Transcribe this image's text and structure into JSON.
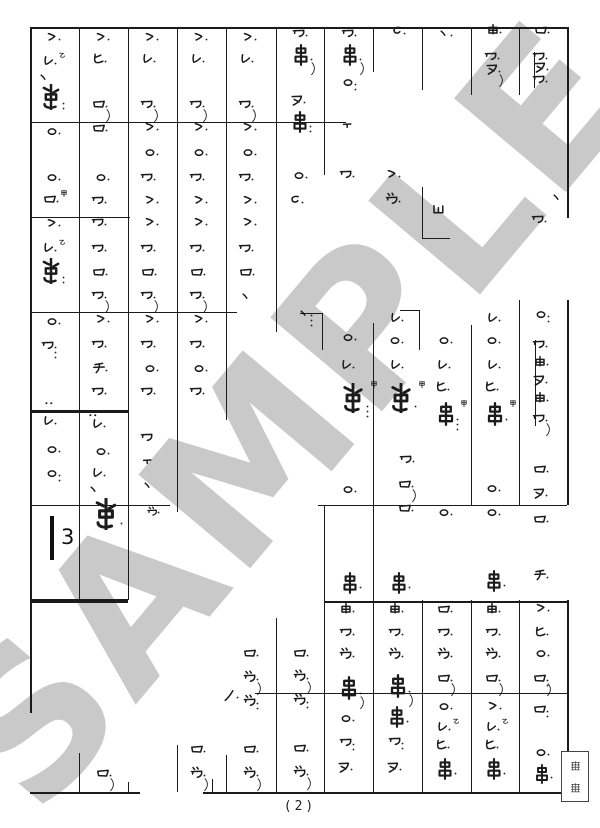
{
  "page": {
    "number": "(2)",
    "background": "#ffffff",
    "ink_color": "#1b1b1b"
  },
  "watermark": {
    "text": "SAMPLE",
    "color": "#c9c9c9",
    "angle_deg": -50
  },
  "rest": {
    "count": "3",
    "bar": {
      "x": 50,
      "y": 516,
      "h": 44,
      "w": 4
    },
    "num_x": 61,
    "num_y": 527
  },
  "label_box": {
    "chars": [
      "怪",
      "獣"
    ]
  },
  "legend": {
    "kan": "甲",
    "otsu": "乙",
    "glyph_names": [
      "ro",
      "wa",
      "dzu",
      "re",
      "gt",
      "circle",
      "chi",
      "hi",
      "nu",
      "yu",
      "kushi",
      "tallc",
      "tt",
      "ub",
      "no",
      "ten",
      "dd",
      "cc"
    ]
  },
  "grid": {
    "hlines": [
      [
        30,
        567,
        27,
        2
      ],
      [
        30,
        346,
        122,
        1
      ],
      [
        30,
        130,
        217,
        1
      ],
      [
        30,
        237,
        312,
        1
      ],
      [
        300,
        322,
        313,
        1
      ],
      [
        400,
        419,
        310,
        1
      ],
      [
        422,
        450,
        238,
        1
      ],
      [
        30,
        128,
        410,
        3
      ],
      [
        30,
        170,
        505,
        1
      ],
      [
        318,
        567,
        505,
        1
      ],
      [
        30,
        128,
        599,
        4
      ],
      [
        324,
        567,
        601,
        2
      ],
      [
        255,
        567,
        693,
        1
      ],
      [
        30,
        140,
        792,
        2
      ],
      [
        203,
        567,
        792,
        2
      ]
    ],
    "vlines": [
      [
        30,
        27,
        713,
        1.5
      ],
      [
        79,
        27,
        600,
        1
      ],
      [
        79,
        753,
        792,
        1
      ],
      [
        128,
        27,
        600,
        1
      ],
      [
        128,
        782,
        792,
        1
      ],
      [
        177,
        27,
        512,
        1
      ],
      [
        177,
        745,
        792,
        1
      ],
      [
        226,
        27,
        420,
        1
      ],
      [
        226,
        755,
        792,
        1
      ],
      [
        276,
        27,
        332,
        1
      ],
      [
        276,
        618,
        792,
        1
      ],
      [
        324,
        27,
        175,
        1
      ],
      [
        322,
        313,
        350,
        1
      ],
      [
        324,
        505,
        792,
        1
      ],
      [
        373,
        27,
        72,
        1
      ],
      [
        373,
        323,
        792,
        1
      ],
      [
        422,
        27,
        90,
        1
      ],
      [
        422,
        187,
        238,
        1
      ],
      [
        419,
        310,
        350,
        1
      ],
      [
        422,
        600,
        792,
        1
      ],
      [
        471,
        27,
        95,
        1
      ],
      [
        471,
        325,
        505,
        1
      ],
      [
        471,
        600,
        792,
        1
      ],
      [
        519,
        27,
        95,
        1
      ],
      [
        519,
        300,
        505,
        1
      ],
      [
        519,
        600,
        792,
        1
      ],
      [
        567,
        27,
        218,
        1.5
      ],
      [
        567,
        300,
        505,
        1.5
      ],
      [
        567,
        600,
        792,
        1.5
      ],
      [
        212,
        779,
        792,
        1
      ],
      [
        534,
        52,
        88,
        0.8
      ],
      [
        535,
        340,
        426,
        0.8
      ]
    ]
  },
  "glyphs": [
    {
      "t": "gt",
      "x": 44,
      "y": 30
    },
    {
      "t": "re",
      "x": 40,
      "y": 54,
      "sup": "otsu"
    },
    {
      "t": "ten",
      "x": 36,
      "y": 70,
      "d": 0
    },
    {
      "t": "tallc",
      "x": 38,
      "y": 84,
      "s": 26,
      "d": 2
    },
    {
      "t": "circle",
      "x": 44,
      "y": 124
    },
    {
      "t": "circle",
      "x": 44,
      "y": 170
    },
    {
      "t": "ro",
      "x": 42,
      "y": 192,
      "sup": "kan"
    },
    {
      "t": "gt",
      "x": 44,
      "y": 216
    },
    {
      "t": "re",
      "x": 40,
      "y": 241,
      "sup": "otsu"
    },
    {
      "t": "tallc",
      "x": 38,
      "y": 258,
      "s": 26,
      "d": 2
    },
    {
      "t": "circle",
      "x": 44,
      "y": 314
    },
    {
      "t": "wa",
      "x": 40,
      "y": 338,
      "d": 3
    },
    {
      "t": "dd",
      "x": 42,
      "y": 396,
      "d": 0
    },
    {
      "t": "re",
      "x": 40,
      "y": 414
    },
    {
      "t": "circle",
      "x": 44,
      "y": 442
    },
    {
      "t": "circle",
      "x": 44,
      "y": 466,
      "d": 2
    },
    {
      "t": "gt",
      "x": 93,
      "y": 30
    },
    {
      "t": "hi",
      "x": 90,
      "y": 52
    },
    {
      "t": "ro",
      "x": 91,
      "y": 97,
      "sl": 1
    },
    {
      "t": "ro",
      "x": 91,
      "y": 121
    },
    {
      "t": "circle",
      "x": 93,
      "y": 170
    },
    {
      "t": "wa",
      "x": 90,
      "y": 193
    },
    {
      "t": "wa",
      "x": 90,
      "y": 215
    },
    {
      "t": "wa",
      "x": 90,
      "y": 241
    },
    {
      "t": "ro",
      "x": 91,
      "y": 265
    },
    {
      "t": "wa",
      "x": 90,
      "y": 288,
      "sl": 1
    },
    {
      "t": "gt",
      "x": 93,
      "y": 312
    },
    {
      "t": "wa",
      "x": 90,
      "y": 337
    },
    {
      "t": "chi",
      "x": 91,
      "y": 361
    },
    {
      "t": "wa",
      "x": 90,
      "y": 384
    },
    {
      "t": "dd",
      "x": 86,
      "y": 408,
      "d": 0
    },
    {
      "t": "re",
      "x": 89,
      "y": 417
    },
    {
      "t": "circle",
      "x": 93,
      "y": 444
    },
    {
      "t": "re",
      "x": 89,
      "y": 466
    },
    {
      "t": "ten",
      "x": 86,
      "y": 482,
      "d": 0
    },
    {
      "t": "tallc",
      "x": 90,
      "y": 498,
      "s": 32
    },
    {
      "t": "ro",
      "x": 95,
      "y": 766,
      "sl": 1
    },
    {
      "t": "gt",
      "x": 142,
      "y": 30
    },
    {
      "t": "re",
      "x": 139,
      "y": 52
    },
    {
      "t": "wa",
      "x": 139,
      "y": 97,
      "sl": 1
    },
    {
      "t": "gt",
      "x": 142,
      "y": 120
    },
    {
      "t": "circle",
      "x": 142,
      "y": 145
    },
    {
      "t": "wa",
      "x": 139,
      "y": 170
    },
    {
      "t": "gt",
      "x": 142,
      "y": 193
    },
    {
      "t": "gt",
      "x": 142,
      "y": 215
    },
    {
      "t": "wa",
      "x": 139,
      "y": 241
    },
    {
      "t": "ro",
      "x": 140,
      "y": 265
    },
    {
      "t": "wa",
      "x": 139,
      "y": 288,
      "sl": 1
    },
    {
      "t": "gt",
      "x": 142,
      "y": 312
    },
    {
      "t": "wa",
      "x": 139,
      "y": 337
    },
    {
      "t": "circle",
      "x": 142,
      "y": 361
    },
    {
      "t": "wa",
      "x": 139,
      "y": 384
    },
    {
      "t": "wa",
      "x": 139,
      "y": 430,
      "d": 0
    },
    {
      "t": "tt",
      "x": 140,
      "y": 456,
      "d": 0
    },
    {
      "t": "ten",
      "x": 140,
      "y": 478,
      "d": 0
    },
    {
      "t": "dzu",
      "x": 146,
      "y": 506,
      "s": 13
    },
    {
      "t": "gt",
      "x": 191,
      "y": 30
    },
    {
      "t": "re",
      "x": 188,
      "y": 52
    },
    {
      "t": "wa",
      "x": 188,
      "y": 97,
      "sl": 1
    },
    {
      "t": "gt",
      "x": 191,
      "y": 120
    },
    {
      "t": "circle",
      "x": 191,
      "y": 145
    },
    {
      "t": "wa",
      "x": 188,
      "y": 170
    },
    {
      "t": "gt",
      "x": 191,
      "y": 193
    },
    {
      "t": "gt",
      "x": 191,
      "y": 215
    },
    {
      "t": "wa",
      "x": 188,
      "y": 241
    },
    {
      "t": "ro",
      "x": 189,
      "y": 265
    },
    {
      "t": "wa",
      "x": 188,
      "y": 288,
      "sl": 1
    },
    {
      "t": "gt",
      "x": 191,
      "y": 312
    },
    {
      "t": "wa",
      "x": 188,
      "y": 337
    },
    {
      "t": "circle",
      "x": 191,
      "y": 361
    },
    {
      "t": "wa",
      "x": 188,
      "y": 384
    },
    {
      "t": "ro",
      "x": 189,
      "y": 742
    },
    {
      "t": "dzu",
      "x": 189,
      "y": 766,
      "sl": 1
    },
    {
      "t": "gt",
      "x": 240,
      "y": 30
    },
    {
      "t": "re",
      "x": 237,
      "y": 52
    },
    {
      "t": "wa",
      "x": 237,
      "y": 97,
      "sl": 1
    },
    {
      "t": "gt",
      "x": 240,
      "y": 120
    },
    {
      "t": "circle",
      "x": 240,
      "y": 145
    },
    {
      "t": "wa",
      "x": 237,
      "y": 170
    },
    {
      "t": "gt",
      "x": 240,
      "y": 193
    },
    {
      "t": "gt",
      "x": 240,
      "y": 215
    },
    {
      "t": "wa",
      "x": 237,
      "y": 241
    },
    {
      "t": "ro",
      "x": 238,
      "y": 265
    },
    {
      "t": "ten",
      "x": 238,
      "y": 289,
      "d": 0
    },
    {
      "t": "no",
      "x": 222,
      "y": 688
    },
    {
      "t": "ro",
      "x": 242,
      "y": 646
    },
    {
      "t": "dzu",
      "x": 242,
      "y": 670,
      "sl": 1
    },
    {
      "t": "dzu",
      "x": 242,
      "y": 694,
      "d": 2
    },
    {
      "t": "ro",
      "x": 242,
      "y": 742
    },
    {
      "t": "dzu",
      "x": 242,
      "y": 766,
      "sl": 1
    },
    {
      "t": "wa",
      "x": 291,
      "y": 26
    },
    {
      "t": "kushi",
      "x": 290,
      "y": 44,
      "s": 22,
      "sl": 1
    },
    {
      "t": "nu",
      "x": 289,
      "y": 93
    },
    {
      "t": "kushi",
      "x": 289,
      "y": 111,
      "s": 22,
      "d": 2
    },
    {
      "t": "circle",
      "x": 291,
      "y": 168
    },
    {
      "t": "cc",
      "x": 287,
      "y": 193
    },
    {
      "t": "ten",
      "x": 296,
      "y": 306,
      "d": 3
    },
    {
      "t": "ro",
      "x": 292,
      "y": 646
    },
    {
      "t": "dzu",
      "x": 292,
      "y": 669,
      "sl": 1
    },
    {
      "t": "dzu",
      "x": 292,
      "y": 693,
      "d": 2
    },
    {
      "t": "ro",
      "x": 292,
      "y": 741
    },
    {
      "t": "dzu",
      "x": 292,
      "y": 765,
      "sl": 1
    },
    {
      "t": "wa",
      "x": 340,
      "y": 26
    },
    {
      "t": "kushi",
      "x": 339,
      "y": 44,
      "s": 22,
      "sl": 1
    },
    {
      "t": "circle",
      "x": 340,
      "y": 75,
      "d": 2
    },
    {
      "t": "tt",
      "x": 340,
      "y": 120,
      "d": 0
    },
    {
      "t": "wa",
      "x": 338,
      "y": 167
    },
    {
      "t": "circle",
      "x": 340,
      "y": 330
    },
    {
      "t": "re",
      "x": 338,
      "y": 358
    },
    {
      "t": "tallc",
      "x": 338,
      "y": 383,
      "s": 30,
      "sup": "kan",
      "d": 3
    },
    {
      "t": "circle",
      "x": 340,
      "y": 482
    },
    {
      "t": "kushi",
      "x": 339,
      "y": 572,
      "s": 22
    },
    {
      "t": "yu",
      "x": 338,
      "y": 602
    },
    {
      "t": "wa",
      "x": 338,
      "y": 625
    },
    {
      "t": "dzu",
      "x": 338,
      "y": 647
    },
    {
      "t": "kushi",
      "x": 337,
      "y": 676,
      "s": 24,
      "sl": 1
    },
    {
      "t": "circle",
      "x": 338,
      "y": 711
    },
    {
      "t": "wa",
      "x": 338,
      "y": 735,
      "d": 2
    },
    {
      "t": "nu",
      "x": 336,
      "y": 760
    },
    {
      "t": "cc",
      "x": 389,
      "y": 24
    },
    {
      "t": "gt",
      "x": 384,
      "y": 167
    },
    {
      "t": "dzu",
      "x": 384,
      "y": 192
    },
    {
      "t": "re",
      "x": 387,
      "y": 311
    },
    {
      "t": "circle",
      "x": 387,
      "y": 333
    },
    {
      "t": "re",
      "x": 387,
      "y": 358
    },
    {
      "t": "tallc",
      "x": 386,
      "y": 383,
      "s": 30,
      "sup": "kan"
    },
    {
      "t": "wa",
      "x": 398,
      "y": 452
    },
    {
      "t": "ro",
      "x": 397,
      "y": 477,
      "sl": 1
    },
    {
      "t": "ro",
      "x": 397,
      "y": 501
    },
    {
      "t": "kushi",
      "x": 388,
      "y": 572,
      "s": 22
    },
    {
      "t": "yu",
      "x": 387,
      "y": 602
    },
    {
      "t": "wa",
      "x": 387,
      "y": 625
    },
    {
      "t": "dzu",
      "x": 387,
      "y": 647
    },
    {
      "t": "kushi",
      "x": 386,
      "y": 674,
      "s": 24,
      "sl": 1
    },
    {
      "t": "kushi",
      "x": 386,
      "y": 706,
      "s": 22
    },
    {
      "t": "wa",
      "x": 387,
      "y": 734,
      "d": 2
    },
    {
      "t": "nu",
      "x": 385,
      "y": 760
    },
    {
      "t": "ten",
      "x": 436,
      "y": 26
    },
    {
      "t": "ub",
      "x": 430,
      "y": 202,
      "d": 0
    },
    {
      "t": "circle",
      "x": 436,
      "y": 333
    },
    {
      "t": "re",
      "x": 434,
      "y": 358
    },
    {
      "t": "hi",
      "x": 433,
      "y": 380
    },
    {
      "t": "kushi",
      "x": 434,
      "y": 402,
      "s": 24,
      "sup": "kan",
      "d": 3
    },
    {
      "t": "circle",
      "x": 436,
      "y": 505
    },
    {
      "t": "ro",
      "x": 436,
      "y": 602
    },
    {
      "t": "wa",
      "x": 436,
      "y": 625
    },
    {
      "t": "dzu",
      "x": 436,
      "y": 647
    },
    {
      "t": "ro",
      "x": 436,
      "y": 671,
      "sl": 1
    },
    {
      "t": "circle",
      "x": 436,
      "y": 699
    },
    {
      "t": "re",
      "x": 434,
      "y": 720,
      "sup": "otsu"
    },
    {
      "t": "hi",
      "x": 433,
      "y": 738
    },
    {
      "t": "kushi",
      "x": 434,
      "y": 758,
      "s": 22
    },
    {
      "t": "yu",
      "x": 485,
      "y": 23
    },
    {
      "t": "wa",
      "x": 483,
      "y": 49
    },
    {
      "t": "nu",
      "x": 484,
      "y": 62,
      "sl": 1
    },
    {
      "t": "re",
      "x": 484,
      "y": 311
    },
    {
      "t": "circle",
      "x": 484,
      "y": 333
    },
    {
      "t": "re",
      "x": 484,
      "y": 358
    },
    {
      "t": "hi",
      "x": 482,
      "y": 380
    },
    {
      "t": "kushi",
      "x": 483,
      "y": 402,
      "s": 24,
      "sup": "kan"
    },
    {
      "t": "circle",
      "x": 484,
      "y": 481
    },
    {
      "t": "circle",
      "x": 484,
      "y": 505
    },
    {
      "t": "kushi",
      "x": 483,
      "y": 570,
      "s": 22
    },
    {
      "t": "yu",
      "x": 484,
      "y": 602
    },
    {
      "t": "wa",
      "x": 484,
      "y": 625
    },
    {
      "t": "dzu",
      "x": 484,
      "y": 647
    },
    {
      "t": "ro",
      "x": 484,
      "y": 671,
      "sl": 1
    },
    {
      "t": "gt",
      "x": 485,
      "y": 699
    },
    {
      "t": "re",
      "x": 483,
      "y": 720,
      "sup": "otsu"
    },
    {
      "t": "hi",
      "x": 482,
      "y": 738
    },
    {
      "t": "kushi",
      "x": 483,
      "y": 758,
      "s": 22
    },
    {
      "t": "ro",
      "x": 533,
      "y": 23
    },
    {
      "t": "wa",
      "x": 531,
      "y": 49
    },
    {
      "t": "nu",
      "x": 532,
      "y": 60
    },
    {
      "t": "wa",
      "x": 531,
      "y": 72
    },
    {
      "t": "ten",
      "x": 549,
      "y": 190,
      "d": 0
    },
    {
      "t": "wa",
      "x": 530,
      "y": 212
    },
    {
      "t": "circle",
      "x": 533,
      "y": 307,
      "d": 2
    },
    {
      "t": "wa",
      "x": 531,
      "y": 337
    },
    {
      "t": "yu",
      "x": 532,
      "y": 355
    },
    {
      "t": "nu",
      "x": 531,
      "y": 373
    },
    {
      "t": "yu",
      "x": 532,
      "y": 391
    },
    {
      "t": "wa",
      "x": 531,
      "y": 411,
      "sl": 1
    },
    {
      "t": "ro",
      "x": 532,
      "y": 462
    },
    {
      "t": "nu",
      "x": 531,
      "y": 486
    },
    {
      "t": "ro",
      "x": 532,
      "y": 512
    },
    {
      "t": "chi",
      "x": 532,
      "y": 568
    },
    {
      "t": "gt",
      "x": 533,
      "y": 601
    },
    {
      "t": "hi",
      "x": 532,
      "y": 625
    },
    {
      "t": "circle",
      "x": 533,
      "y": 646
    },
    {
      "t": "ro",
      "x": 532,
      "y": 671,
      "sl": 1,
      "d": 2
    },
    {
      "t": "ro",
      "x": 532,
      "y": 702,
      "d": 2
    },
    {
      "t": "circle",
      "x": 533,
      "y": 745
    },
    {
      "t": "kushi",
      "x": 532,
      "y": 764,
      "s": 20
    }
  ]
}
